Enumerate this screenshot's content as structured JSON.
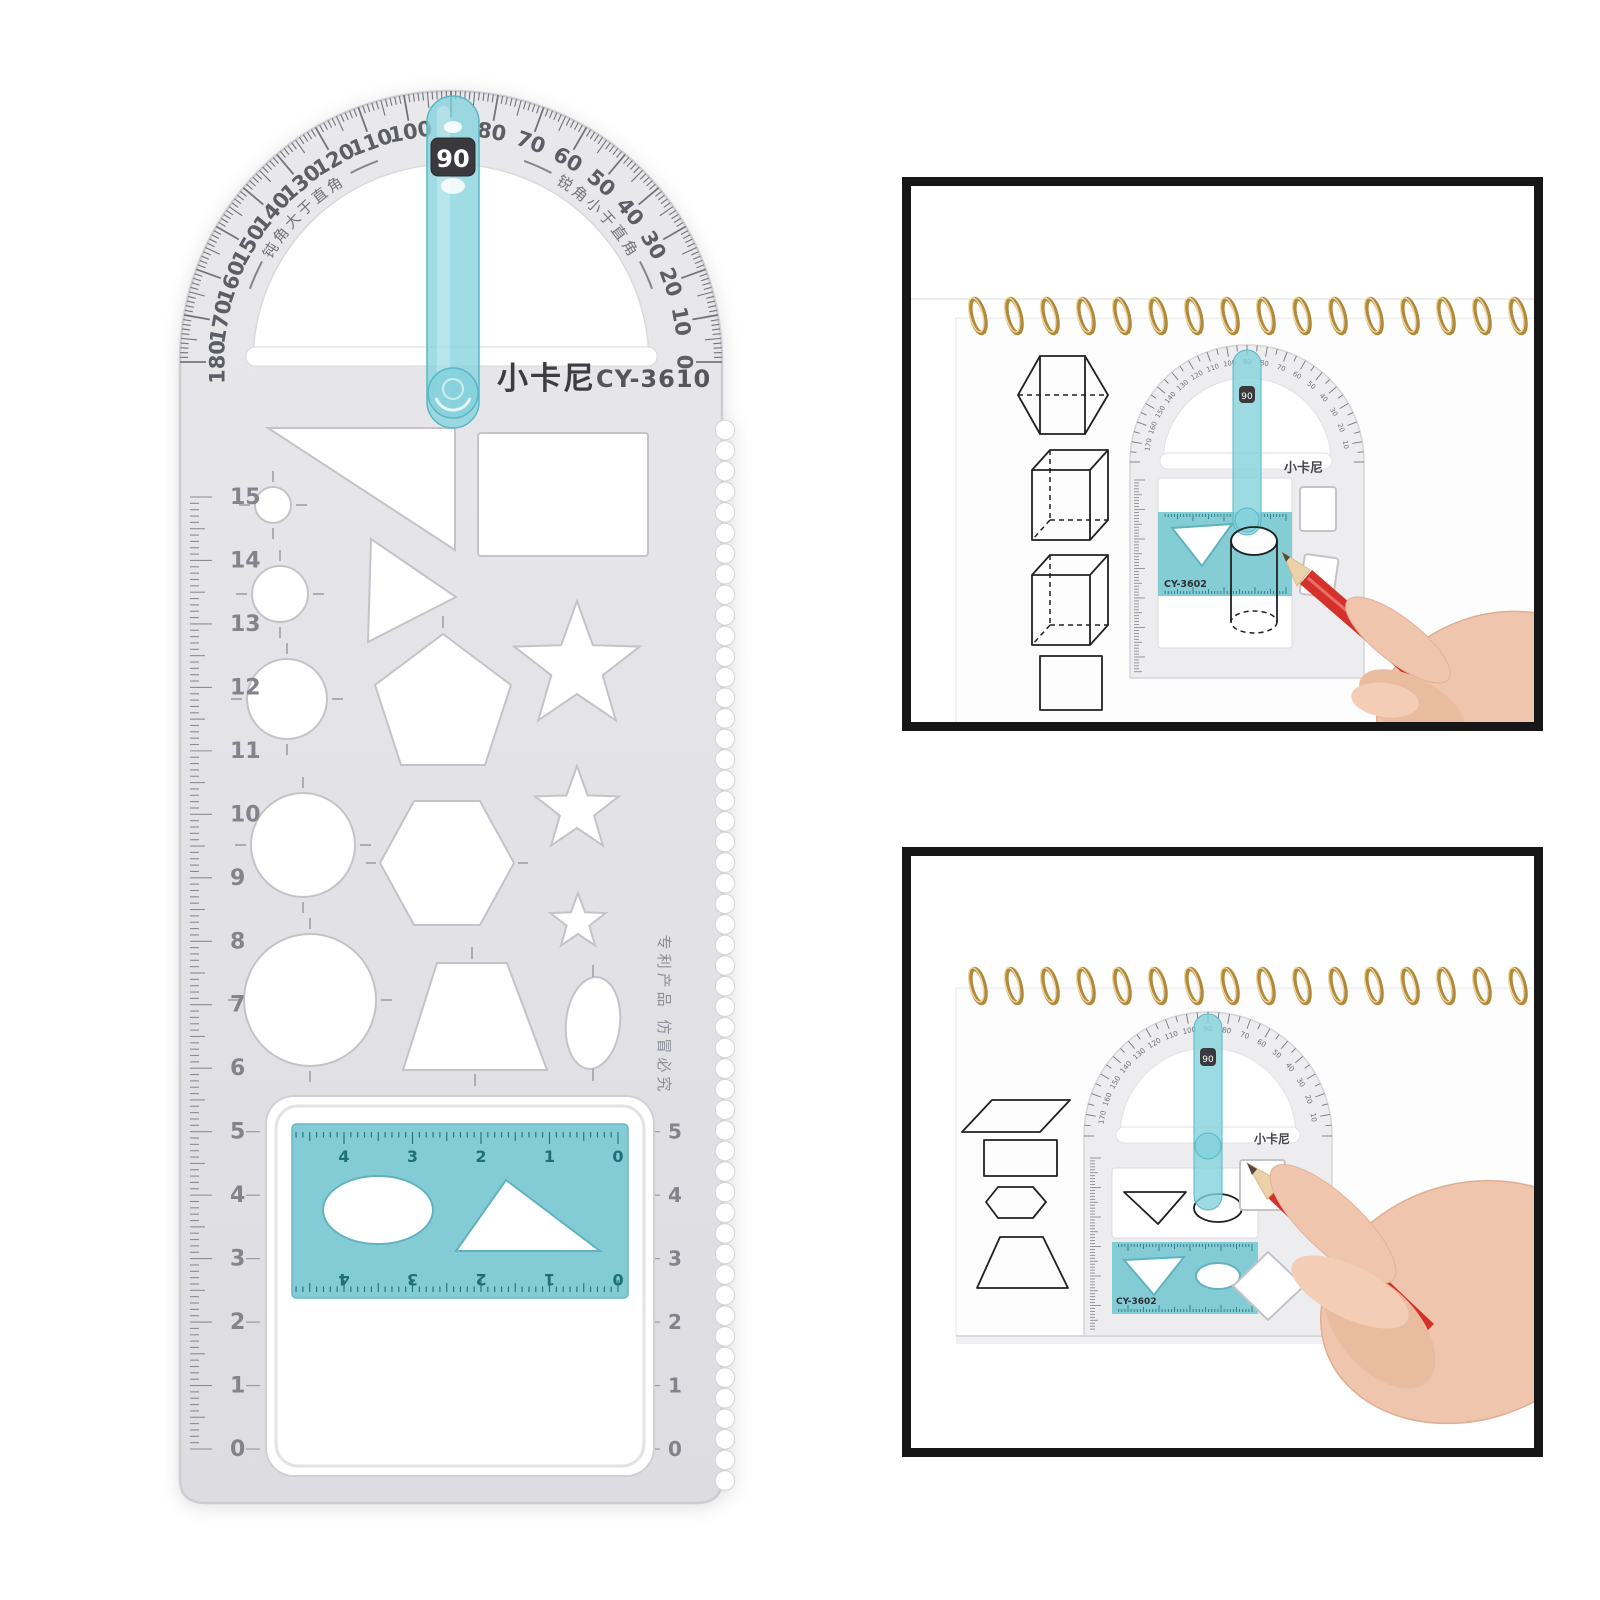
{
  "ruler": {
    "brand": "小卡尼",
    "model": "CY-3610",
    "angle_window": "90",
    "protractor_degree_labels": [
      "180",
      "170",
      "160",
      "150",
      "140",
      "130",
      "120",
      "110",
      "100",
      "90",
      "80",
      "70",
      "60",
      "50",
      "40",
      "30",
      "20",
      "10",
      "0"
    ],
    "arc_text_obtuse": "钝角大于直角",
    "arc_text_acute": "锐角小于直角",
    "side_note": "专利产品 仿冒必究",
    "left_scale_labels": [
      "15",
      "14",
      "13",
      "12",
      "11",
      "10",
      "9",
      "8",
      "7",
      "6",
      "5",
      "4",
      "3",
      "2",
      "1",
      "0"
    ],
    "window_scale_labels": [
      "5",
      "4",
      "3",
      "2",
      "1",
      "0"
    ],
    "insert_scale_labels": [
      "4",
      "3",
      "2",
      "1",
      "0"
    ],
    "colors": {
      "teal": "#85d2dc",
      "teal_insert": "#7ecad3",
      "teal_dark": "#1e6f7a",
      "body_gray": "#e4e4e7"
    }
  },
  "insets": {
    "top": {
      "brand": "小卡尼",
      "model": "CY-3602",
      "angle_window": "90"
    },
    "bottom": {
      "brand": "小卡尼",
      "model": "CY-3602",
      "angle_window": "90"
    }
  },
  "photo_colors": {
    "spiral_gold": "#b2893a",
    "pencil_red": "#d6302b",
    "hand_skin": "#efc6ad"
  }
}
